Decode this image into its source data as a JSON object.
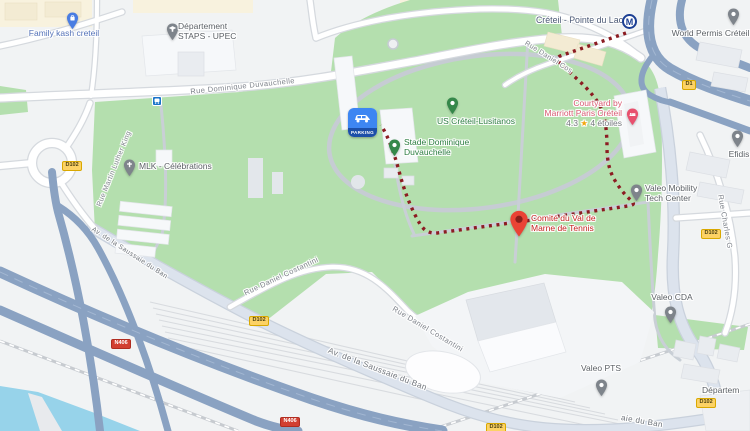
{
  "map": {
    "station": {
      "name": "Créteil - Pointe du Lac",
      "metro_symbol": "M"
    },
    "pois": {
      "family_kash": "Family kash creteil",
      "dept_staps": "Département STAPS - UPEC",
      "world_permis": "World Permis Créteil",
      "mlk": "MLK - Célébrations",
      "us_creteil": "US Créteil-Lusitanos",
      "stade": "Stade Dominique Duvauchelle",
      "courtyard": {
        "line1": "Courtyard by",
        "line2": "Marriott Paris Créteil",
        "rating": "4.3",
        "star": "★",
        "reviews": "4 étoiles"
      },
      "efidis": "Efidis",
      "valeo_mobility": "Valeo Mobility Tech Center",
      "valeo_cda": "Valeo CDA",
      "valeo_pts": "Valeo PTS",
      "tennis": "Comité du Val de Marne de Tennis",
      "departement_partial": "Départem"
    },
    "streets": {
      "rue_dominique_duvauchelle": "Rue Dominique Duvauchelle",
      "rue_martin_luther_king": "Rue Martin Luther King",
      "av_saussaie_1": "Av. de la Saussaie du Ban",
      "av_saussaie_2": "Av. de la Saussaie du Ban",
      "av_saussaie_3": "aie du Ban",
      "rue_daniel_costantini_1": "Rue Daniel Costantini",
      "rue_daniel_costantini_2": "Rue Daniel Costantini",
      "rue_daniel_costantini_3": "Rue Daniel Cos",
      "rue_charles": "Rue Charles G"
    },
    "shields": {
      "d1": "D1",
      "d102": "D102",
      "n406": "N406"
    },
    "parking_label": "PARKING",
    "colors": {
      "park_green": "#b4dfae",
      "water_blue": "#97d3ea",
      "highway_blue": "#8aa2c2",
      "route_red": "#8c1c22",
      "poi_green": "#2c7d41",
      "hotel_pink": "#e8506e",
      "destination_red": "#ea4335",
      "shield_yellow": "#fcd265",
      "shield_red": "#d23f31",
      "metro_navy": "#1c3f94",
      "parking_blue": "#3d86f2"
    }
  }
}
